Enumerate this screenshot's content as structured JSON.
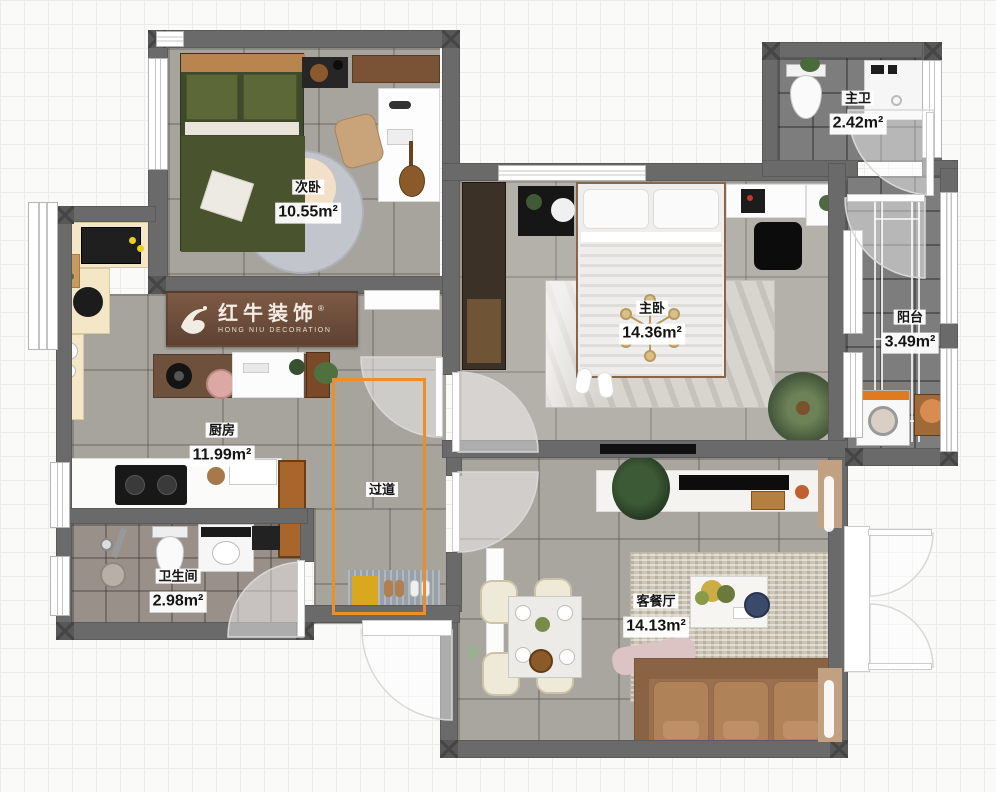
{
  "canvas": {
    "width": 996,
    "height": 792
  },
  "brand": {
    "name_cn": "红牛装饰",
    "name_en": "HONG NIU DECORATION",
    "registered_mark": "®"
  },
  "rooms": [
    {
      "key": "ciwo",
      "name": "次卧",
      "area": "10.55m²"
    },
    {
      "key": "zhuwo",
      "name": "主卧",
      "area": "14.36m²"
    },
    {
      "key": "zhuwei",
      "name": "主卫",
      "area": "2.42m²"
    },
    {
      "key": "yangtai",
      "name": "阳台",
      "area": "3.49m²"
    },
    {
      "key": "chufang",
      "name": "厨房",
      "area": "11.99m²"
    },
    {
      "key": "guodao",
      "name": "过道",
      "area": ""
    },
    {
      "key": "weishengjian",
      "name": "卫生间",
      "area": "2.98m²"
    },
    {
      "key": "kecanting",
      "name": "客餐厅",
      "area": "14.13m²"
    }
  ],
  "colors": {
    "wall": "#6a6a6a",
    "accent_orange": "#e8912c",
    "logo_wood": "#6b4a38",
    "bed_green": "#49542f",
    "sofa_brown": "#9a714e"
  }
}
